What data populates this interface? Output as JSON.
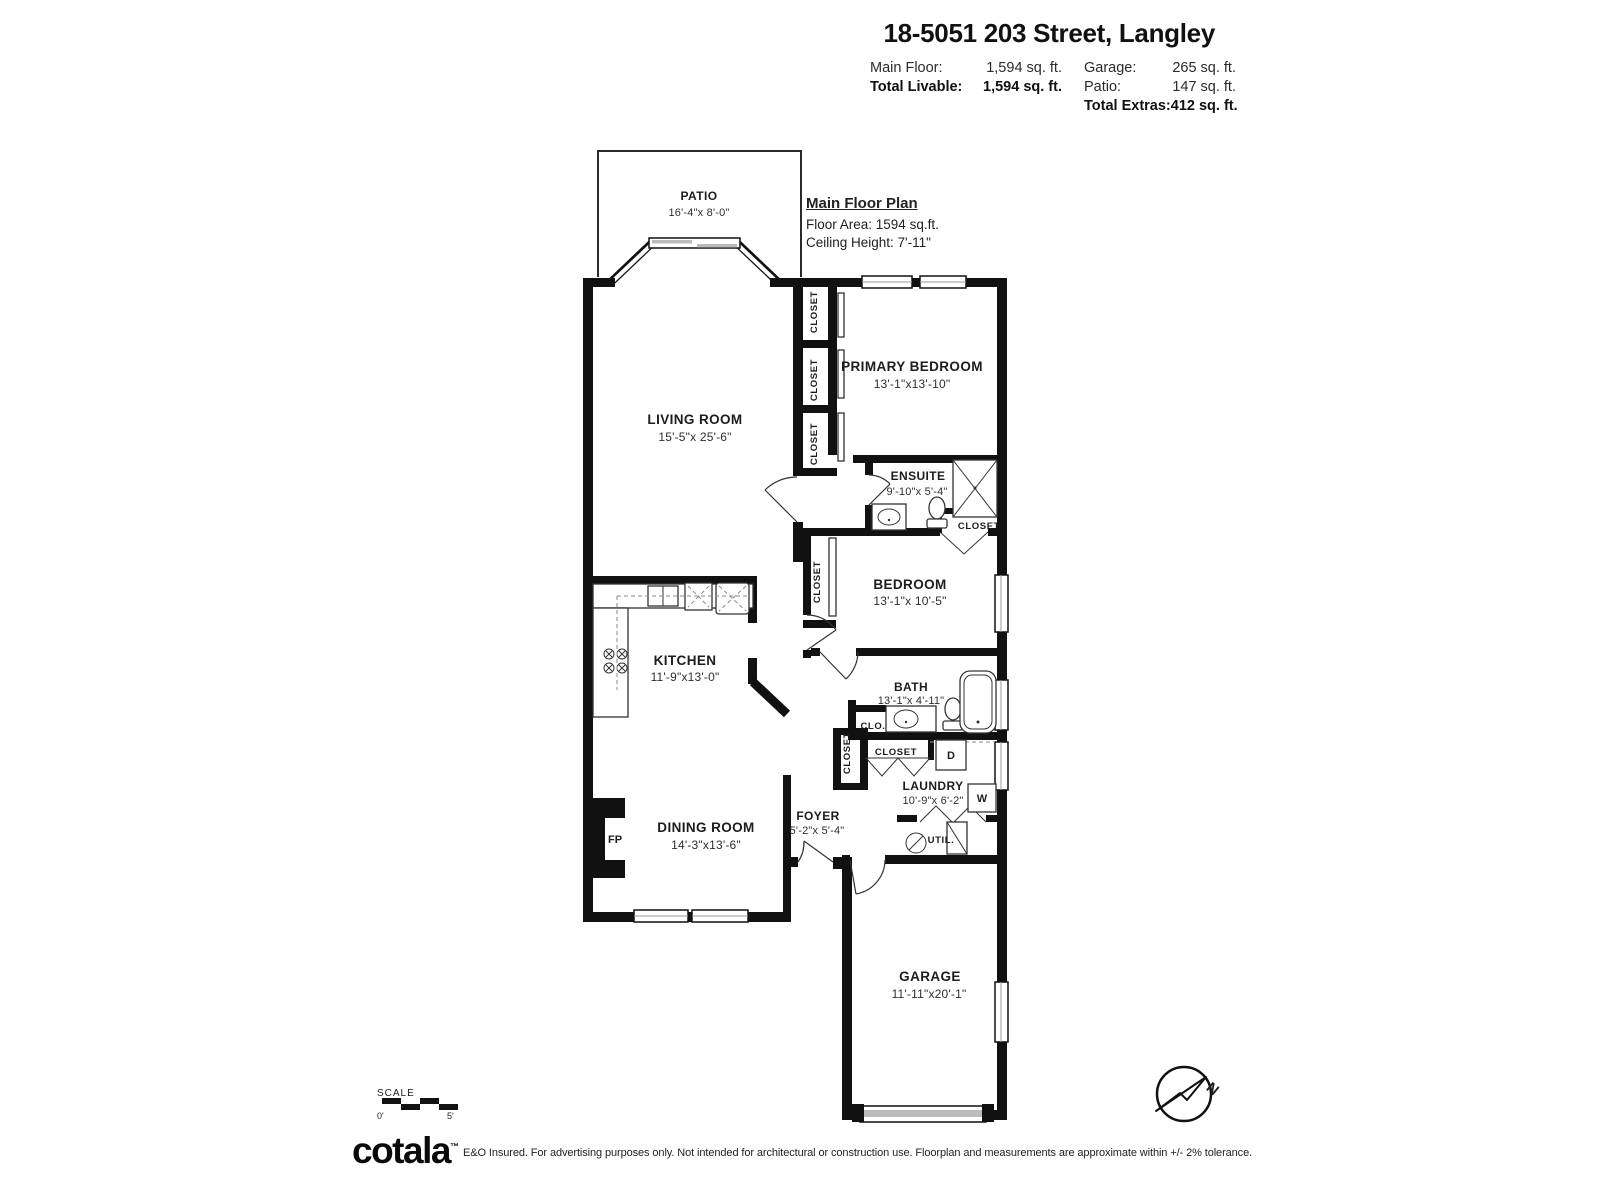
{
  "header": {
    "title": "18-5051 203 Street, Langley",
    "main_floor_label": "Main Floor:",
    "main_floor_value": "1,594 sq. ft.",
    "total_livable_label": "Total Livable:",
    "total_livable_value": "1,594 sq. ft.",
    "garage_label": "Garage:",
    "garage_value": "265 sq. ft.",
    "patio_label": "Patio:",
    "patio_value": "147 sq. ft.",
    "total_extras_label": "Total Extras:",
    "total_extras_value": "412 sq. ft."
  },
  "plan_info": {
    "title": "Main Floor Plan",
    "floor_area": "Floor Area: 1594 sq.ft.",
    "ceiling_height": "Ceiling Height: 7'-11\""
  },
  "rooms": {
    "patio": {
      "name": "PATIO",
      "dims": "16'-4\"x 8'-0\""
    },
    "living": {
      "name": "LIVING ROOM",
      "dims": "15'-5\"x 25'-6\""
    },
    "primary": {
      "name": "PRIMARY BEDROOM",
      "dims": "13'-1\"x13'-10\""
    },
    "ensuite": {
      "name": "ENSUITE",
      "dims": "9'-10\"x 5'-4\""
    },
    "bedroom": {
      "name": "BEDROOM",
      "dims": "13'-1\"x 10'-5\""
    },
    "kitchen": {
      "name": "KITCHEN",
      "dims": "11'-9\"x13'-0\""
    },
    "bath": {
      "name": "BATH",
      "dims": "13'-1\"x 4'-11\""
    },
    "laundry": {
      "name": "LAUNDRY",
      "dims": "10'-9\"x 6'-2\""
    },
    "dining": {
      "name": "DINING ROOM",
      "dims": "14'-3\"x13'-6\""
    },
    "foyer": {
      "name": "FOYER",
      "dims": "5'-2\"x 5'-4\""
    },
    "garage": {
      "name": "GARAGE",
      "dims": "11'-11\"x20'-1\""
    }
  },
  "labels": {
    "closet": "CLOSET",
    "clo": "CLO.",
    "util": "UTIL.",
    "fireplace": "FP",
    "dryer": "D",
    "washer": "W",
    "north": "N"
  },
  "scale": {
    "label": "SCALE",
    "start": "0'",
    "end": "5'"
  },
  "footer": {
    "brand": "cotala",
    "tm": "™",
    "disclaimer": "E&O Insured. For advertising purposes only. Not intended for architectural or construction use. Floorplan and measurements are approximate within +/- 2% tolerance."
  },
  "colors": {
    "wall": "#111111",
    "text": "#1d1d1d",
    "window_line": "#999999",
    "panel_gray": "#bbbbbb"
  }
}
